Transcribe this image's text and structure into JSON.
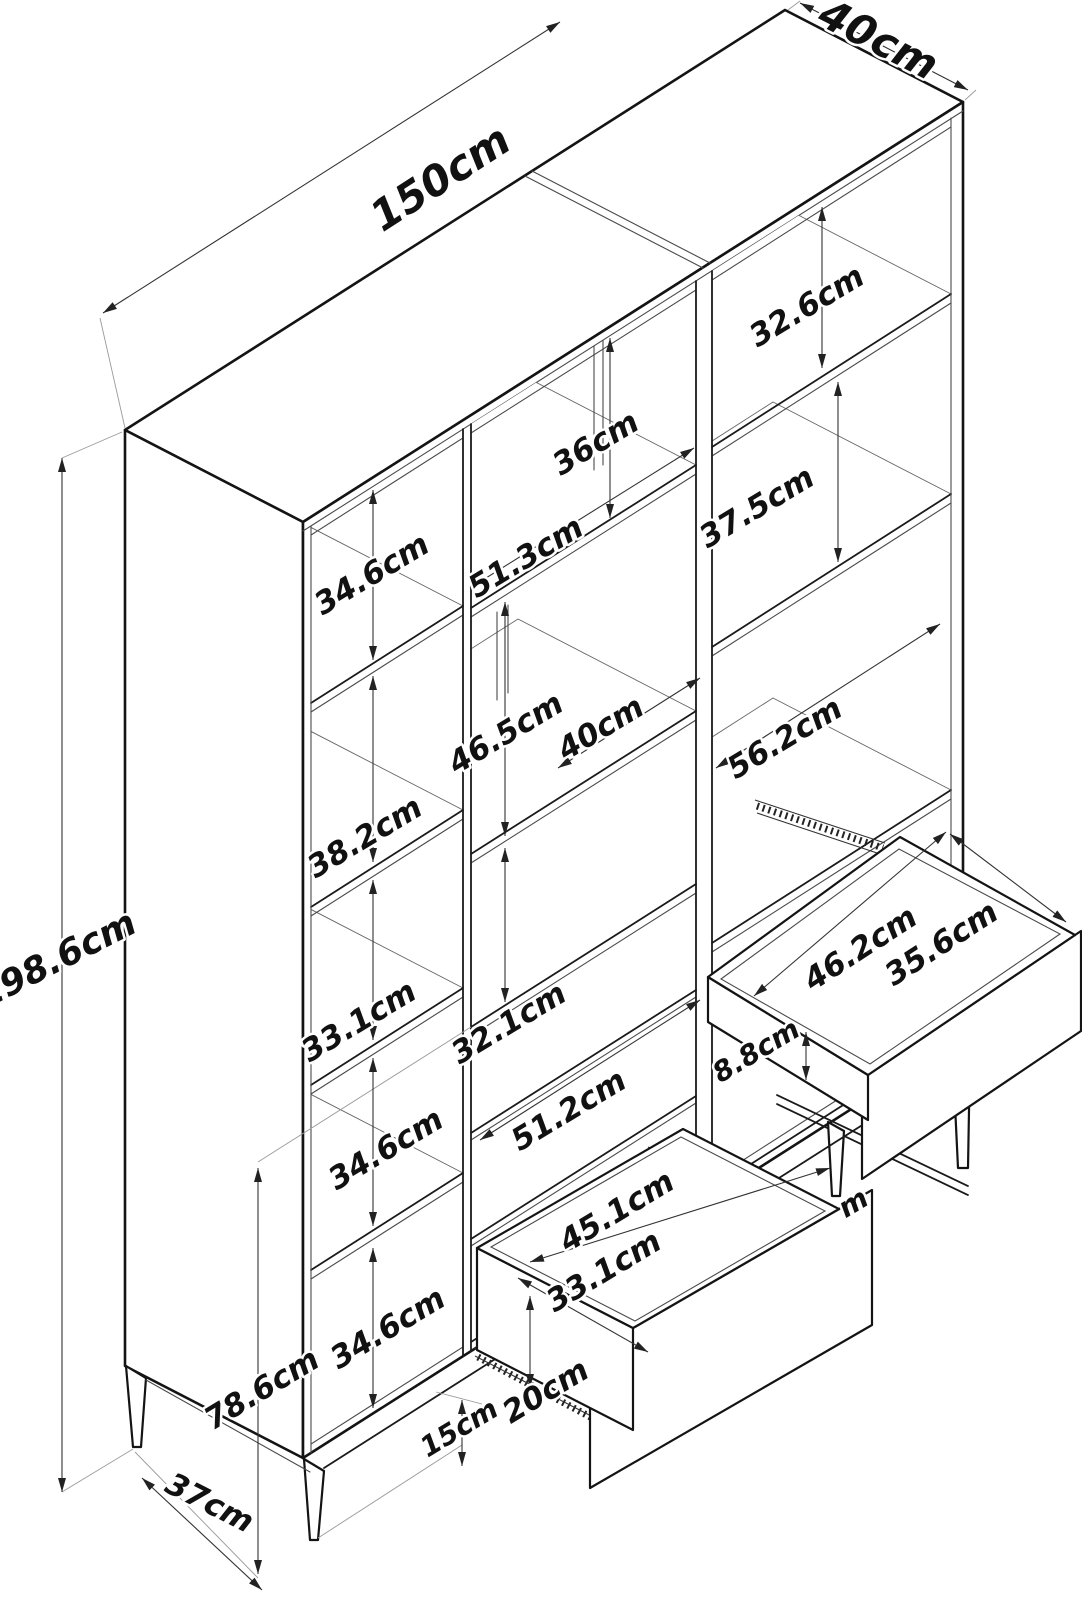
{
  "document": {
    "type": "furniture-dimension-diagram",
    "subject": "three-column shelving cabinet with pull-out drawers",
    "unit": "cm"
  },
  "dimensions": {
    "total_width": "150cm",
    "total_depth": "40cm",
    "total_height": "198.6cm",
    "left_column_openings": [
      "34.6cm",
      "38.2cm",
      "33.1cm",
      "34.6cm",
      "34.6cm"
    ],
    "middle_column": {
      "top_opening": "36cm",
      "interior_width": "51.3cm",
      "middle_opening": "46.5cm",
      "nook_width": "40cm",
      "lower_opening": "32.1cm",
      "drawer_area_width": "51.2cm"
    },
    "drawer": {
      "interior_width": "45.1cm",
      "interior_depth": "33.1cm",
      "height": "20cm"
    },
    "right_column": {
      "top_opening": "32.6cm",
      "second_opening": "37.5cm",
      "interior_width": "56.2cm"
    },
    "tray": {
      "interior_width": "46.2cm",
      "interior_depth": "35.6cm",
      "front_height": "8.8cm"
    },
    "base": {
      "lower_section_height": "78.6cm",
      "leg_height": "15cm",
      "base_depth": "37cm"
    },
    "clipped_label": "m"
  }
}
